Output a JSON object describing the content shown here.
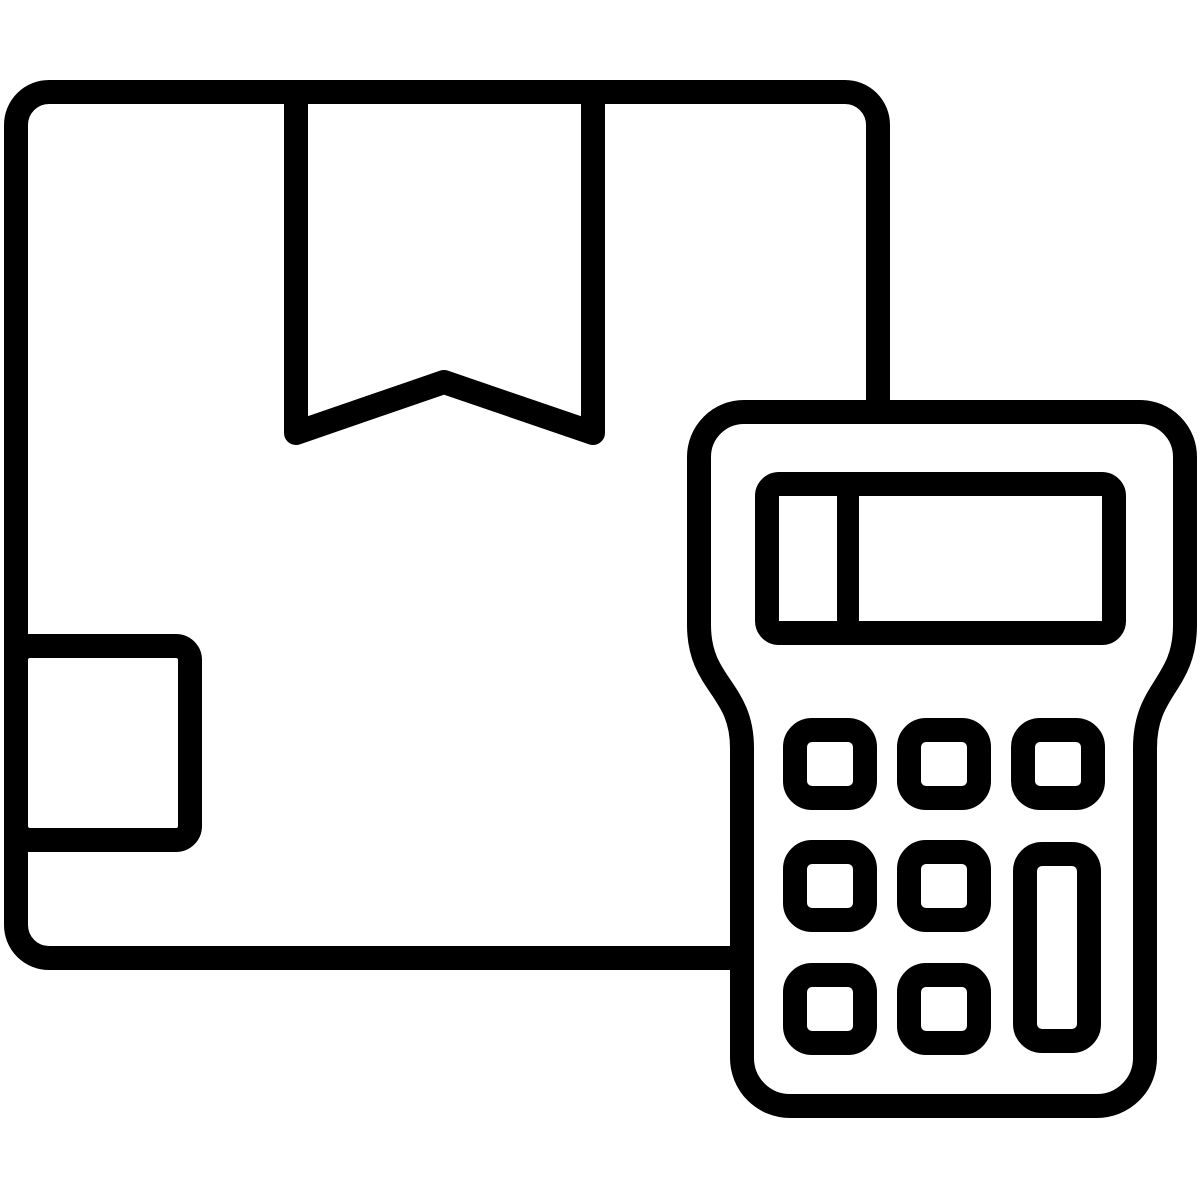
{
  "icon": {
    "name": "package-with-calculator-icon",
    "style": "outline",
    "colors": {
      "line": "#000000",
      "background": "#ffffff",
      "fill": "#ffffff"
    },
    "parts": {
      "box": "package-box",
      "flap": "tape-flap",
      "label": "shipping-label",
      "calculator": "calculator",
      "display": "calculator-display",
      "display_divider": "display-divider",
      "keypad": "keypad-buttons",
      "tall_key": "tall-key"
    }
  }
}
